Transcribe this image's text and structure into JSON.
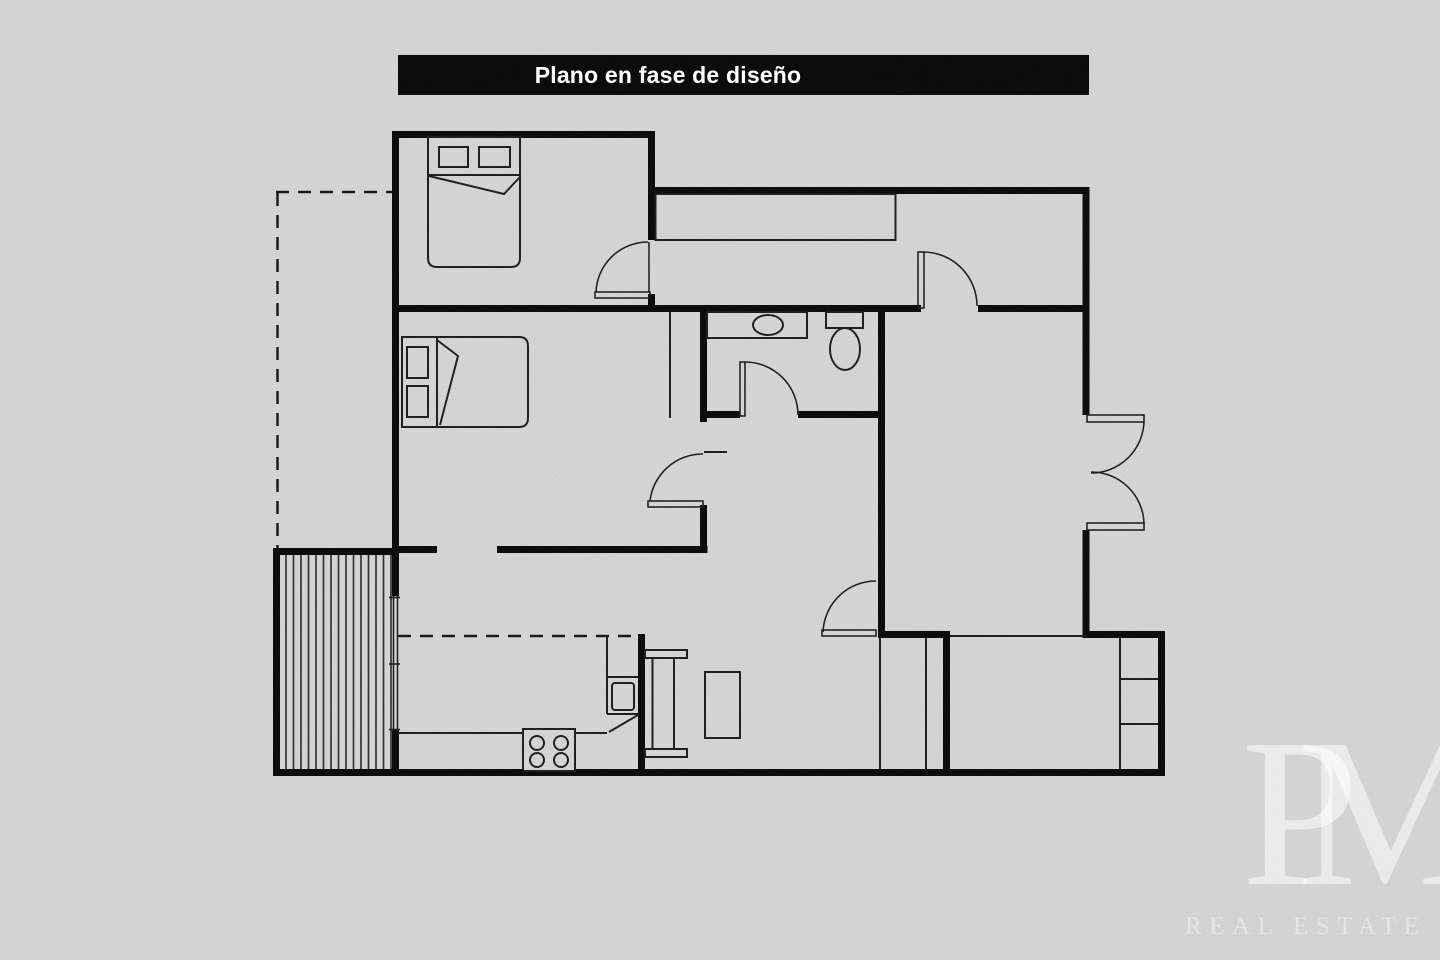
{
  "title_banner": {
    "text": "Plano en fase de diseño",
    "bg_color": "#0a0a0a",
    "text_color": "#ffffff"
  },
  "watermark": {
    "monogram": "PM",
    "subtitle": "REAL ESTATE",
    "color": "rgba(255,255,255,0.5)"
  },
  "colors": {
    "background": "#cdcdcd",
    "wall_line": "#0b0b0b",
    "furniture_line": "#1c1c1c"
  }
}
